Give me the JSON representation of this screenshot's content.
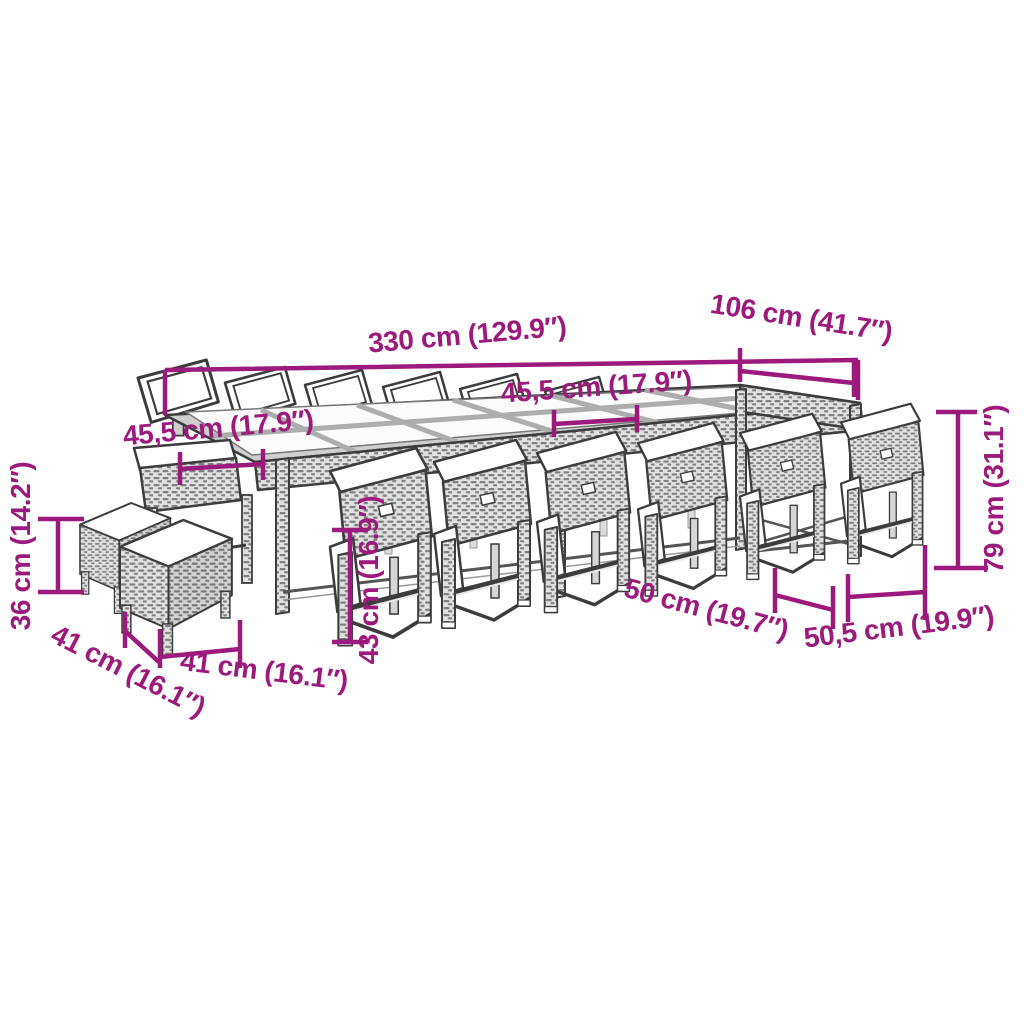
{
  "diagram": {
    "product": "Rattan garden dining set with glass-top table, cushioned chairs and stools",
    "style": {
      "dimension_color": "#9c1a7b",
      "line_color": "#3c3c3c",
      "background": "#ffffff"
    },
    "dimensions": [
      {
        "id": "table-length",
        "label": "330 cm (129.9″)"
      },
      {
        "id": "table-width",
        "label": "106 cm (41.7″)"
      },
      {
        "id": "chair-width-back",
        "label": "45,5 cm (17.9″)"
      },
      {
        "id": "chair-width-left",
        "label": "45,5 cm (17.9″)"
      },
      {
        "id": "stool-height",
        "label": "36 cm (14.2″)"
      },
      {
        "id": "stool-depth",
        "label": "41 cm (16.1″)"
      },
      {
        "id": "stool-width",
        "label": "41 cm (16.1″)"
      },
      {
        "id": "chair-seat-height",
        "label": "43 cm (16.9″)"
      },
      {
        "id": "chair-depth",
        "label": "50 cm (19.7″)"
      },
      {
        "id": "chair-width-front",
        "label": "50,5 cm (19.9″)"
      },
      {
        "id": "chair-height",
        "label": "79 cm (31.1″)"
      }
    ]
  }
}
